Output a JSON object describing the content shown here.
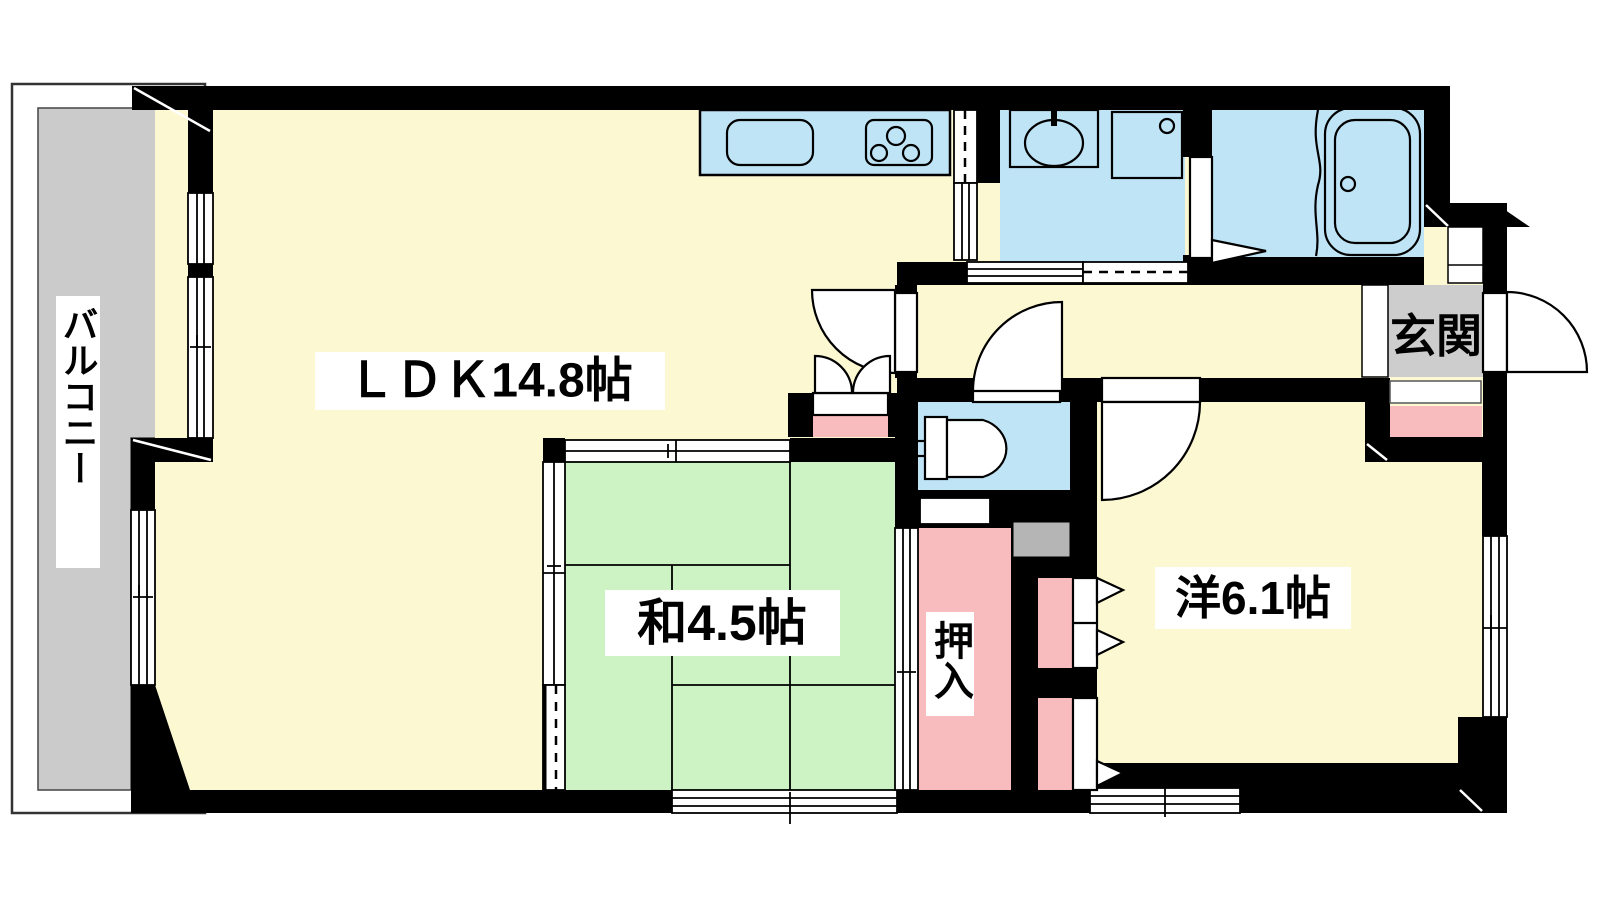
{
  "floorplan": {
    "type": "apartment-floor-plan",
    "rooms": {
      "balcony": {
        "label": "バルコニー"
      },
      "ldk": {
        "label": "ＬＤＫ14.8帖"
      },
      "washitsu": {
        "label": "和4.5帖"
      },
      "youshitsu": {
        "label": "洋6.1帖"
      },
      "oshiire": {
        "label": "押入"
      },
      "genkan": {
        "label": "玄関"
      }
    },
    "fixtures": [
      "kitchen-counter-sink",
      "kitchen-stove",
      "washroom-vanity",
      "washing-machine-pan",
      "bathtub",
      "toilet"
    ],
    "colors": {
      "wall": "#000000",
      "floor_yellow": "#FCF8D2",
      "tatami_green": "#CDF3C5",
      "water_blue": "#BFE4F6",
      "closet_pink": "#F8BBBE",
      "balcony_gray": "#CBCBCB",
      "genkan_gray": "#CDCDCD",
      "utility_gray": "#B5B5B5"
    }
  }
}
